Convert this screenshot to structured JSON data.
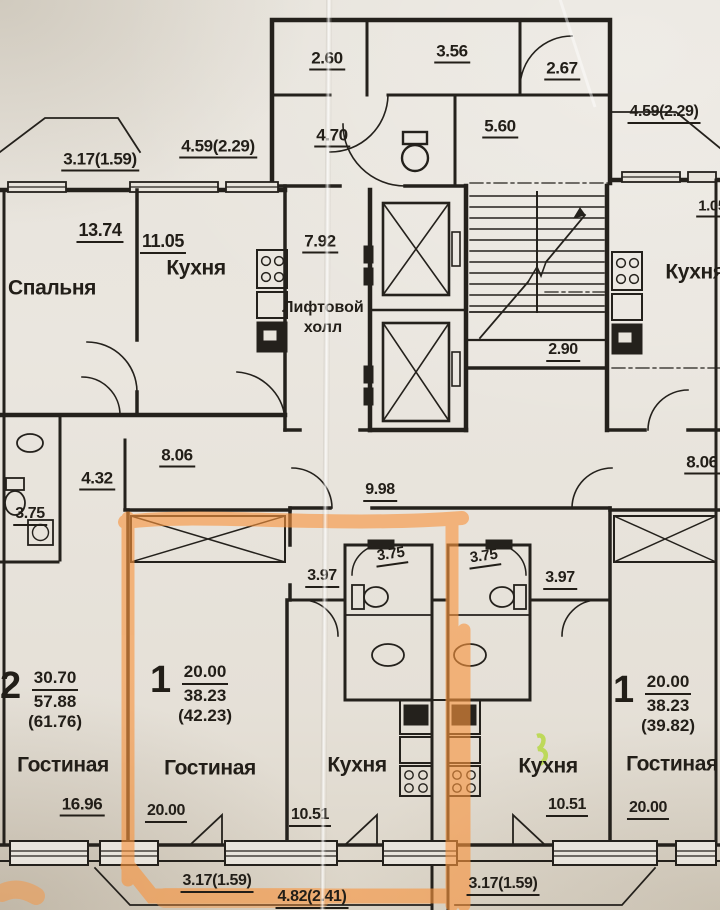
{
  "plan": {
    "language": "ru",
    "type": "apartment floor plan photo",
    "highlight_color": "#f99a46",
    "ink_color": "#221e18",
    "paper_color": "#e8e4dc",
    "green_mark_color": "#bfdc4e"
  },
  "rooms": {
    "bedroom_tl": "Спальня",
    "kitchen_tl": "Кухня",
    "kitchen_tr": "Кухня",
    "lift_hall_l1": "Лифтовой",
    "lift_hall_l2": "холл",
    "living_u2": "Гостиная",
    "living_u1l": "Гостиная",
    "kitchen_u1l": "Кухня",
    "kitchen_u1r": "Кухня",
    "living_u1r": "Гостиная"
  },
  "units": {
    "u2": {
      "num": "2",
      "living": "30.70",
      "total": "57.88",
      "extra": "(61.76)"
    },
    "u1l": {
      "num": "1",
      "living": "20.00",
      "total": "38.23",
      "extra": "(42.23)"
    },
    "u1r": {
      "num": "1",
      "living": "20.00",
      "total": "38.23",
      "extra": "(39.82)"
    }
  },
  "dims": {
    "d317a": "3.17(1.59)",
    "d459a": "4.59(2.29)",
    "d260": "2.60",
    "d356": "3.56",
    "d267": "2.67",
    "d470": "4.70",
    "d560": "5.60",
    "d459b": "4.59(2.29)",
    "d105": "1.05",
    "d1374": "13.74",
    "d1105": "11.05",
    "d792": "7.92",
    "d290": "2.90",
    "d806a": "8.06",
    "d432": "4.32",
    "d375a": "3.75",
    "d998": "9.98",
    "d397a": "3.97",
    "d375b": "3.75",
    "d375c": "3.75",
    "d397b": "3.97",
    "d806b": "8.06",
    "d1696": "16.96",
    "d2000a": "20.00",
    "d317b": "3.17(1.59)",
    "d1051a": "10.51",
    "d482": "4.82(2.41)",
    "d1051b": "10.51",
    "d317c": "3.17(1.59)",
    "d2000b": "20.00"
  }
}
